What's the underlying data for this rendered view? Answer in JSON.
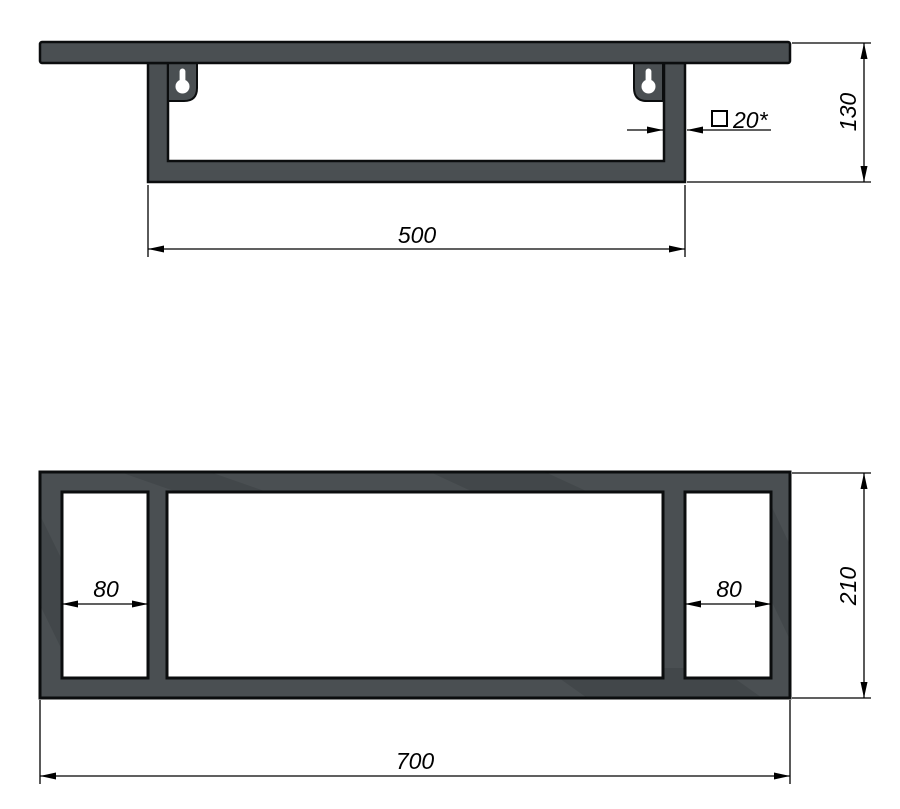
{
  "title": "wall-shelf-technical-drawing",
  "colors": {
    "frame_fill": "#4a4f52",
    "outline": "#0b0d0e",
    "dim_color": "#000000",
    "background": "#ffffff"
  },
  "icons": {
    "square_section_symbol": "□",
    "keyhole_mount": "keyhole-slot"
  },
  "front_view": {
    "dim_width": "500",
    "dim_height": "130",
    "tube_note": "20*"
  },
  "plan_view": {
    "dim_left_opening": "80",
    "dim_right_opening": "80",
    "dim_depth": "210",
    "dim_length": "700"
  }
}
